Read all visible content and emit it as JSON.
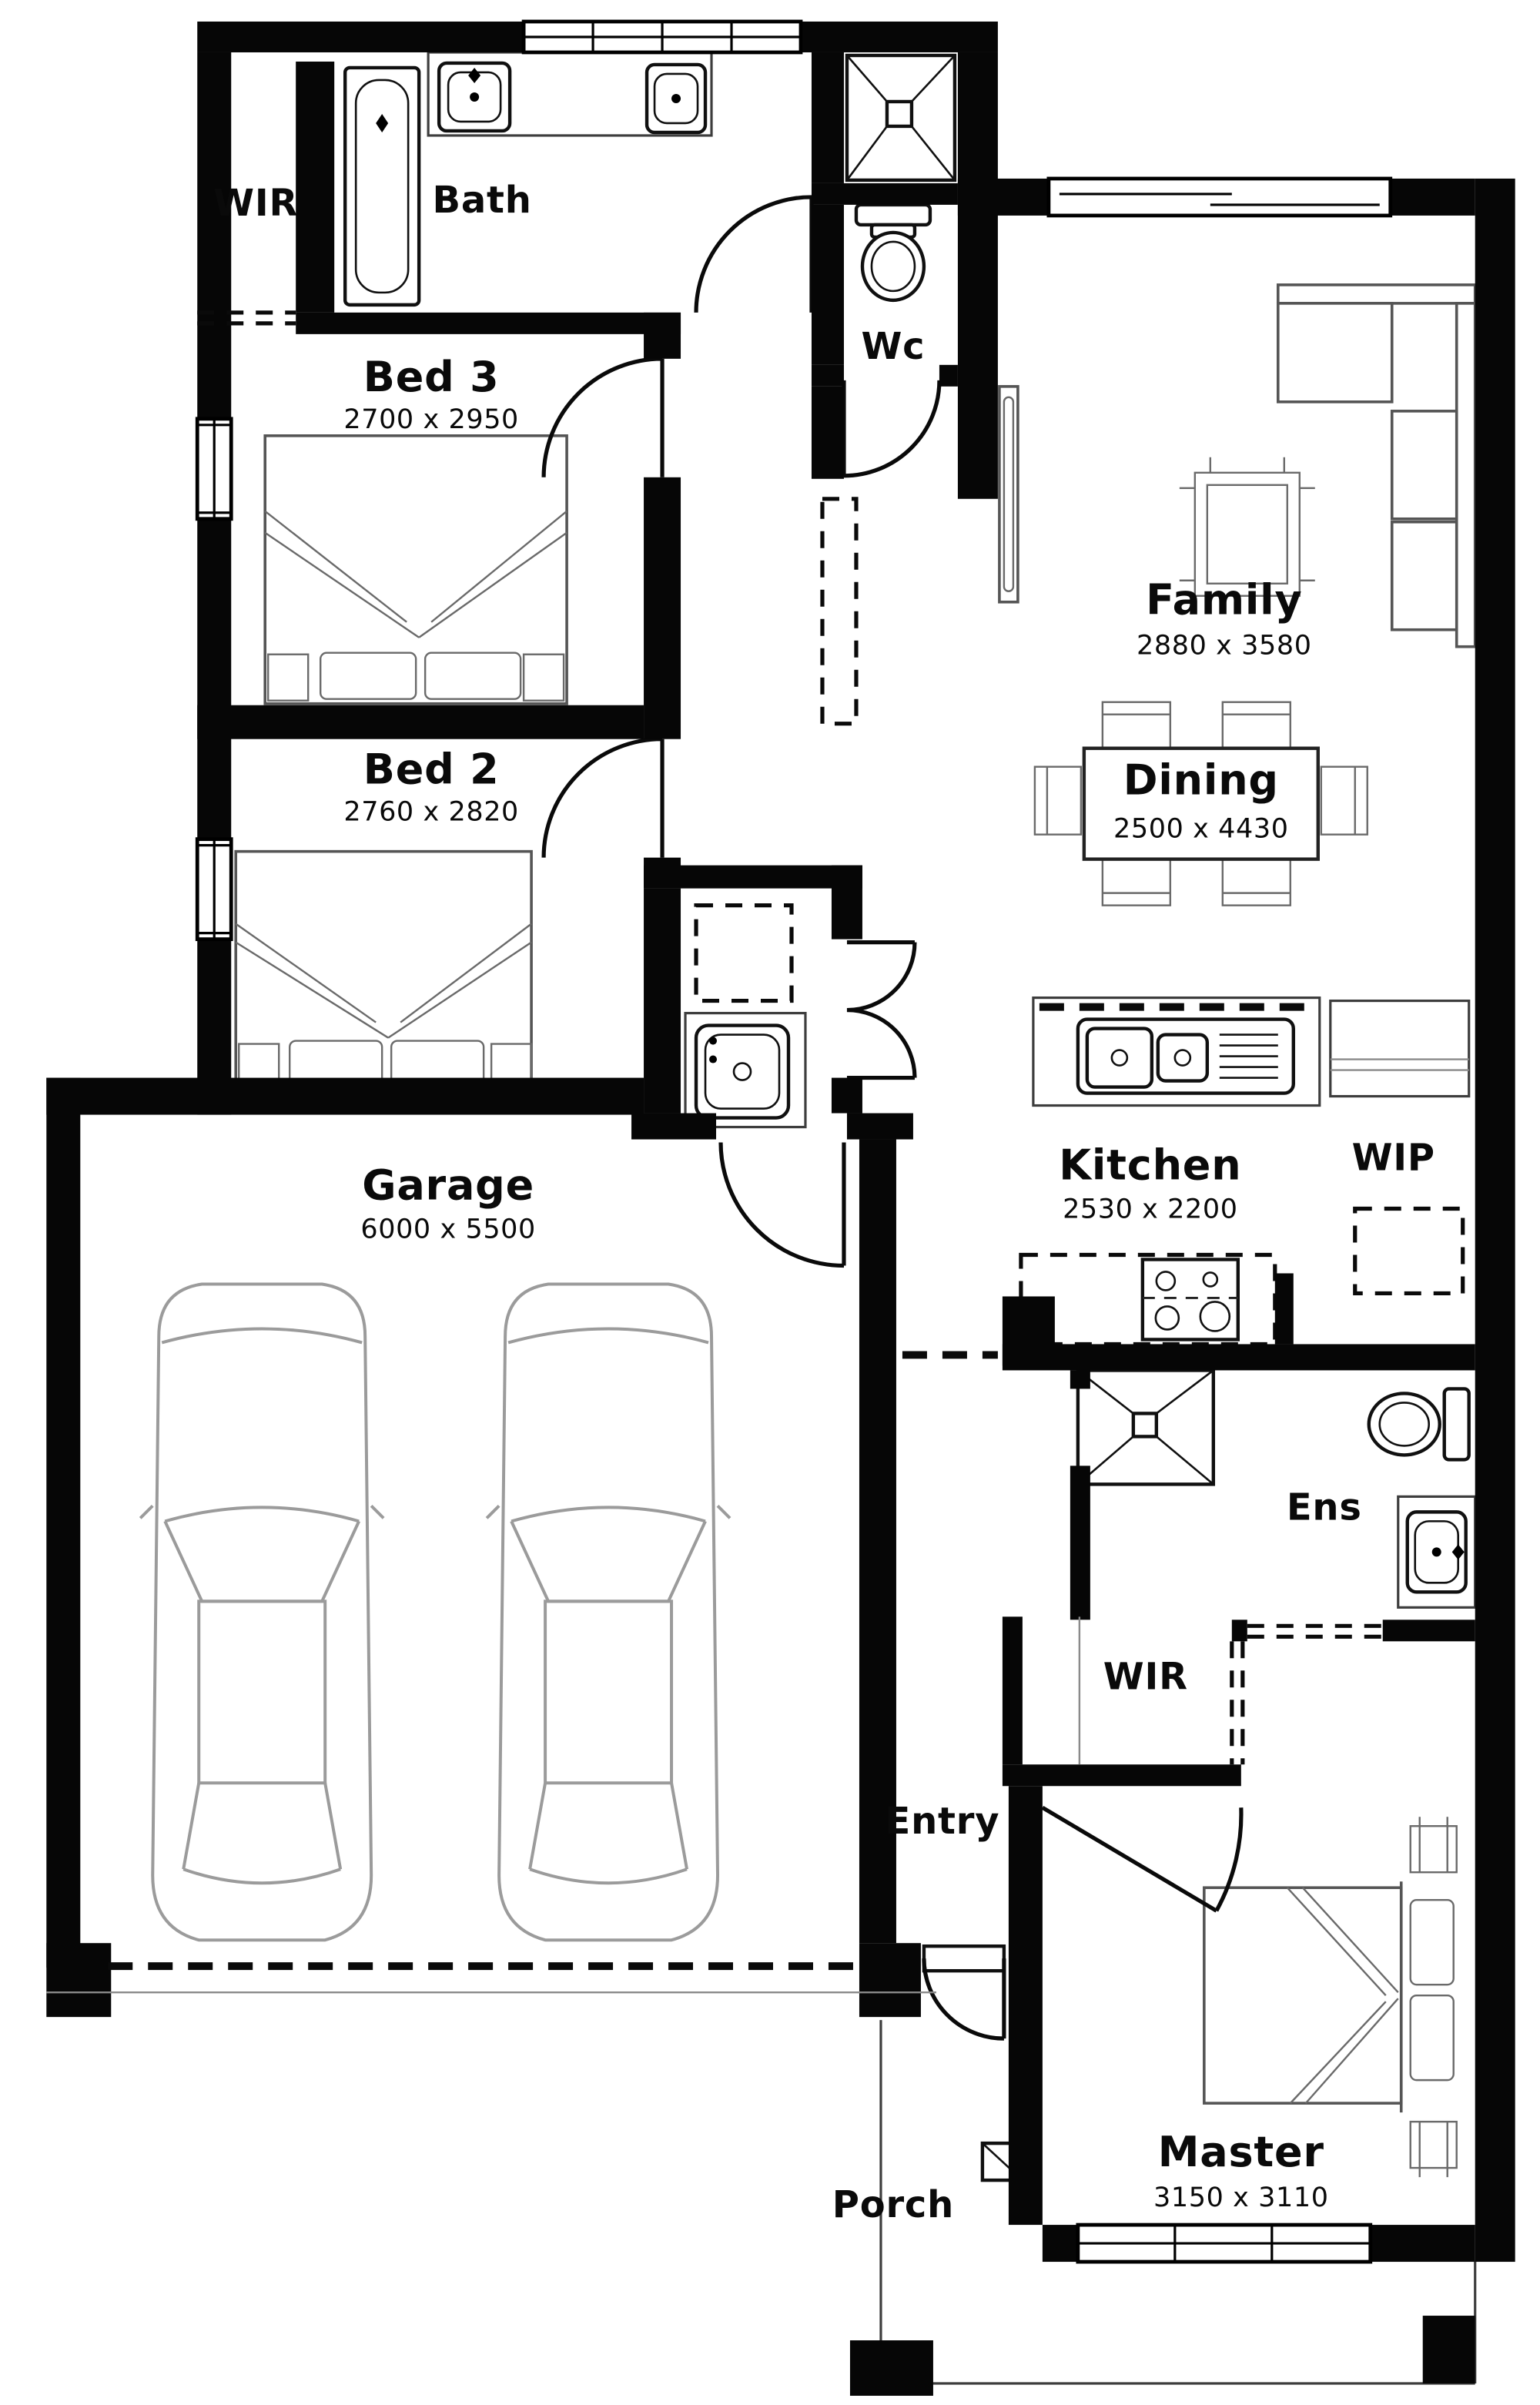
{
  "plan": {
    "type": "floor-plan",
    "colors": {
      "wall": "#060606",
      "background": "#ffffff",
      "furniture_line": "#555555",
      "car_line": "#9b9b9b"
    },
    "rooms": {
      "wir1": {
        "label": "WIR"
      },
      "bath": {
        "label": "Bath"
      },
      "wc": {
        "label": "Wc"
      },
      "bed3": {
        "label": "Bed 3",
        "dims": "2700 x 2950"
      },
      "bed2": {
        "label": "Bed 2",
        "dims": "2760 x 2820"
      },
      "family": {
        "label": "Family",
        "dims": "2880 x 3580"
      },
      "dining": {
        "label": "Dining",
        "dims": "2500 x 4430"
      },
      "kitchen": {
        "label": "Kitchen",
        "dims": "2530 x 2200"
      },
      "wip": {
        "label": "WIP"
      },
      "garage": {
        "label": "Garage",
        "dims": "6000 x 5500"
      },
      "ens": {
        "label": "Ens"
      },
      "wir2": {
        "label": "WIR"
      },
      "entry": {
        "label": "Entry"
      },
      "master": {
        "label": "Master",
        "dims": "3150 x 3110"
      },
      "porch": {
        "label": "Porch"
      }
    }
  }
}
